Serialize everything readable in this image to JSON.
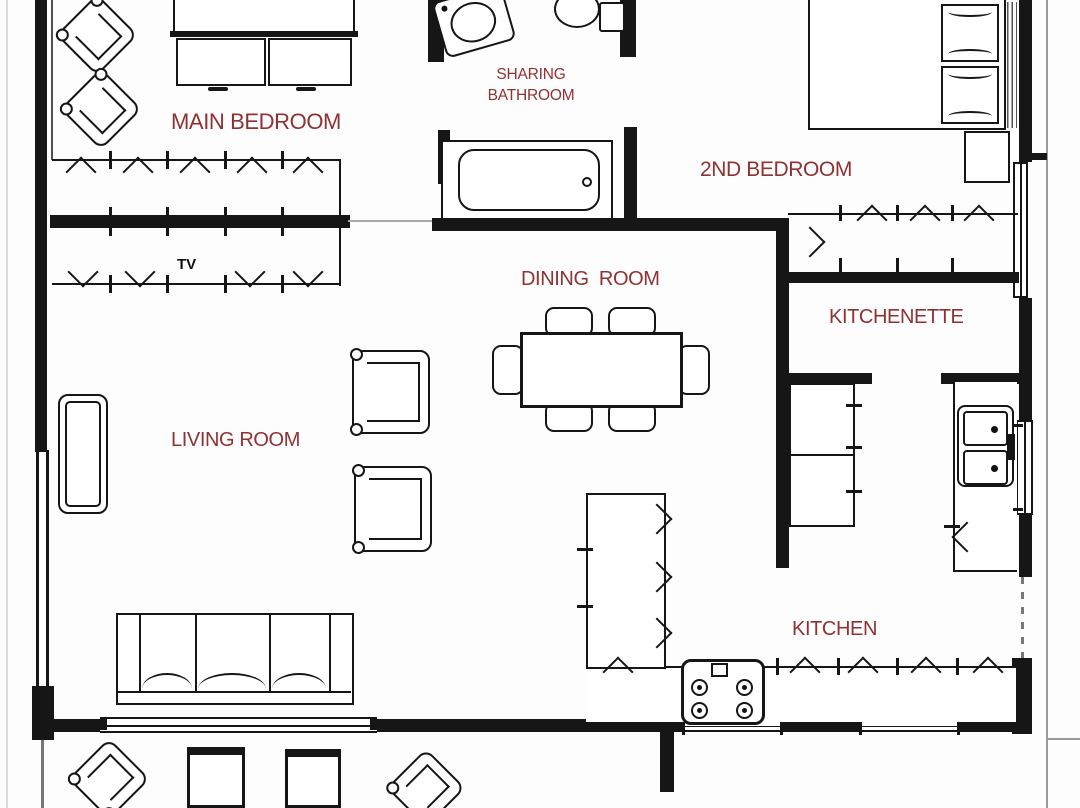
{
  "colors": {
    "wall": "#161616",
    "label": "#8e3233",
    "bg": "#fdfdfd"
  },
  "labels": {
    "main_bedroom": "MAIN BEDROOM",
    "sharing_bathroom_line1": "SHARING",
    "sharing_bathroom_line2": "BATHROOM",
    "second_bedroom": "2ND BEDROOM",
    "dining_room": "DINING  ROOM",
    "kitchenette": "KITCHENETTE",
    "living_room": "LIVING ROOM",
    "kitchen": "KITCHEN",
    "tv": "TV"
  }
}
